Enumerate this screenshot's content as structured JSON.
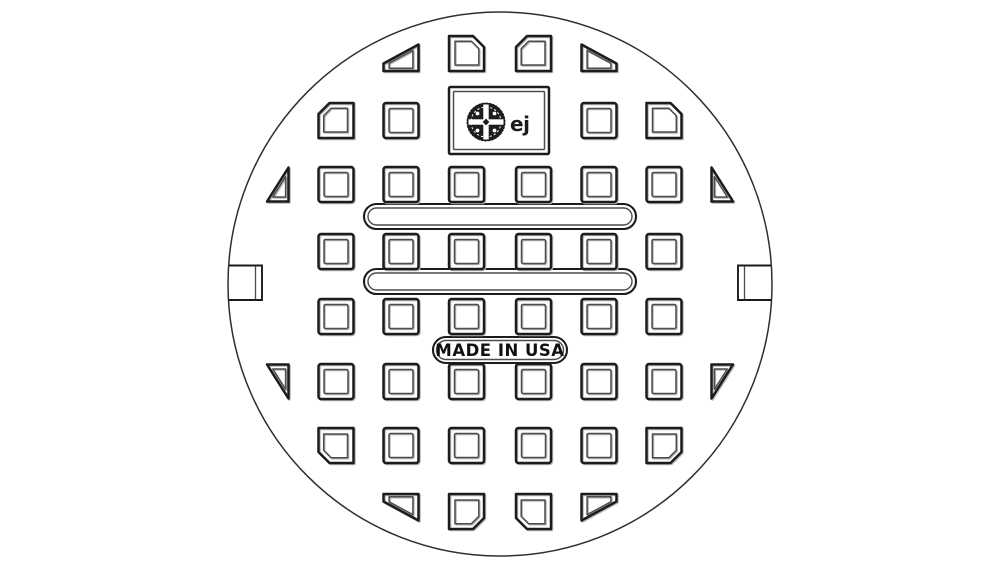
{
  "drawing": {
    "type": "technical-line-drawing",
    "subject": "round manhole cover, top view, waffle vent pattern",
    "background_color": "#ffffff",
    "line_color": "#1c1c1c",
    "bevel_line_color": "#4d4d4d",
    "stamp": {
      "text": "MADE IN USA"
    },
    "logo": {
      "text": "ej"
    },
    "circle": {
      "cx": 500,
      "cy": 284,
      "r": 272
    },
    "slots": [
      {
        "x": 364,
        "y": 204,
        "w": 272,
        "h": 25
      },
      {
        "x": 364,
        "y": 269,
        "w": 272,
        "h": 25
      }
    ],
    "grid": {
      "col_centers": [
        271,
        336,
        401,
        466.5,
        533.5,
        599,
        664,
        729
      ],
      "row_centers": [
        53.5,
        120.5,
        184.5,
        251.5,
        316.5,
        381.5,
        445.5,
        511.5
      ],
      "shapes": {
        "slant-tl": [
          [
            -17.5,
            17.5
          ],
          [
            17.5,
            17.5
          ],
          [
            17.5,
            -9
          ],
          [
            -17.5,
            10
          ]
        ],
        "slant-tr": [
          [
            17.5,
            17.5
          ],
          [
            -17.5,
            17.5
          ],
          [
            -17.5,
            -9
          ],
          [
            17.5,
            10
          ]
        ],
        "slant-bl": [
          [
            -17.5,
            -17.5
          ],
          [
            17.5,
            -17.5
          ],
          [
            17.5,
            9
          ],
          [
            -17.5,
            -10
          ]
        ],
        "slant-br": [
          [
            17.5,
            -17.5
          ],
          [
            -17.5,
            -17.5
          ],
          [
            -17.5,
            9
          ],
          [
            17.5,
            -10
          ]
        ],
        "ch-tl": [
          [
            -17.5,
            -6.5
          ],
          [
            -6.5,
            -17.5
          ],
          [
            17.5,
            -17.5
          ],
          [
            17.5,
            17.5
          ],
          [
            -17.5,
            17.5
          ]
        ],
        "ch-tr": [
          [
            17.5,
            -6.5
          ],
          [
            6.5,
            -17.5
          ],
          [
            -17.5,
            -17.5
          ],
          [
            -17.5,
            17.5
          ],
          [
            17.5,
            17.5
          ]
        ],
        "ch-bl": [
          [
            -17.5,
            6.5
          ],
          [
            -6.5,
            17.5
          ],
          [
            17.5,
            17.5
          ],
          [
            17.5,
            -17.5
          ],
          [
            -17.5,
            -17.5
          ]
        ],
        "ch-br": [
          [
            17.5,
            6.5
          ],
          [
            6.5,
            17.5
          ],
          [
            -17.5,
            17.5
          ],
          [
            -17.5,
            -17.5
          ],
          [
            17.5,
            -17.5
          ]
        ],
        "wedge-l-up": [
          [
            17.5,
            -17
          ],
          [
            17.5,
            17
          ],
          [
            -4,
            17
          ]
        ],
        "wedge-l-dn": [
          [
            17.5,
            17
          ],
          [
            17.5,
            -17
          ],
          [
            -4,
            -17
          ]
        ],
        "wedge-r-up": [
          [
            -17.5,
            -17
          ],
          [
            -17.5,
            17
          ],
          [
            4,
            17
          ]
        ],
        "wedge-r-dn": [
          [
            -17.5,
            17
          ],
          [
            -17.5,
            -17
          ],
          [
            4,
            -17
          ]
        ]
      },
      "cells": [
        {
          "r": 1,
          "c": 3,
          "t": "slant-tl"
        },
        {
          "r": 1,
          "c": 4,
          "t": "ch-tr"
        },
        {
          "r": 1,
          "c": 5,
          "t": "ch-tl"
        },
        {
          "r": 1,
          "c": 6,
          "t": "slant-tr"
        },
        {
          "r": 2,
          "c": 2,
          "t": "ch-tl"
        },
        {
          "r": 2,
          "c": 3,
          "t": "sq"
        },
        {
          "r": 2,
          "c": 6,
          "t": "sq"
        },
        {
          "r": 2,
          "c": 7,
          "t": "ch-tr"
        },
        {
          "r": 3,
          "c": 1,
          "t": "wedge-l-up"
        },
        {
          "r": 3,
          "c": 2,
          "t": "sq"
        },
        {
          "r": 3,
          "c": 3,
          "t": "sq"
        },
        {
          "r": 3,
          "c": 4,
          "t": "sq"
        },
        {
          "r": 3,
          "c": 5,
          "t": "sq"
        },
        {
          "r": 3,
          "c": 6,
          "t": "sq"
        },
        {
          "r": 3,
          "c": 7,
          "t": "sq"
        },
        {
          "r": 3,
          "c": 8,
          "t": "wedge-r-up"
        },
        {
          "r": 4,
          "c": 2,
          "t": "sq"
        },
        {
          "r": 4,
          "c": 3,
          "t": "sq"
        },
        {
          "r": 4,
          "c": 4,
          "t": "sq"
        },
        {
          "r": 4,
          "c": 5,
          "t": "sq"
        },
        {
          "r": 4,
          "c": 6,
          "t": "sq"
        },
        {
          "r": 4,
          "c": 7,
          "t": "sq"
        },
        {
          "r": 5,
          "c": 2,
          "t": "sq"
        },
        {
          "r": 5,
          "c": 3,
          "t": "sq"
        },
        {
          "r": 5,
          "c": 4,
          "t": "sq"
        },
        {
          "r": 5,
          "c": 5,
          "t": "sq"
        },
        {
          "r": 5,
          "c": 6,
          "t": "sq"
        },
        {
          "r": 5,
          "c": 7,
          "t": "sq"
        },
        {
          "r": 6,
          "c": 1,
          "t": "wedge-l-dn"
        },
        {
          "r": 6,
          "c": 2,
          "t": "sq"
        },
        {
          "r": 6,
          "c": 3,
          "t": "sq"
        },
        {
          "r": 6,
          "c": 4,
          "t": "sq"
        },
        {
          "r": 6,
          "c": 5,
          "t": "sq"
        },
        {
          "r": 6,
          "c": 6,
          "t": "sq"
        },
        {
          "r": 6,
          "c": 7,
          "t": "sq"
        },
        {
          "r": 6,
          "c": 8,
          "t": "wedge-r-dn"
        },
        {
          "r": 7,
          "c": 2,
          "t": "ch-bl"
        },
        {
          "r": 7,
          "c": 3,
          "t": "sq"
        },
        {
          "r": 7,
          "c": 4,
          "t": "sq"
        },
        {
          "r": 7,
          "c": 5,
          "t": "sq"
        },
        {
          "r": 7,
          "c": 6,
          "t": "sq"
        },
        {
          "r": 7,
          "c": 7,
          "t": "ch-br"
        },
        {
          "r": 8,
          "c": 3,
          "t": "slant-bl"
        },
        {
          "r": 8,
          "c": 4,
          "t": "ch-br"
        },
        {
          "r": 8,
          "c": 5,
          "t": "ch-bl"
        },
        {
          "r": 8,
          "c": 6,
          "t": "slant-br"
        }
      ]
    }
  }
}
